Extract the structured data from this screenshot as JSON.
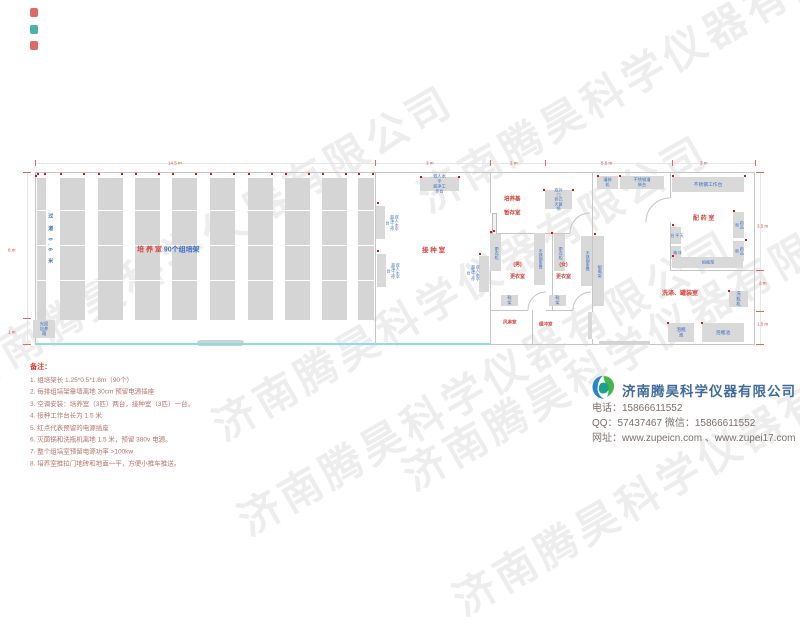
{
  "watermark": {
    "text": "济南腾昊科学仪器有限公司",
    "positions": [
      [
        -55,
        350
      ],
      [
        200,
        400
      ],
      [
        405,
        172
      ],
      [
        225,
        495
      ],
      [
        440,
        575
      ],
      [
        390,
        450
      ]
    ]
  },
  "corner_marks": [
    {
      "x": 30,
      "y": 8,
      "color": "#d4554b"
    },
    {
      "x": 30,
      "y": 25,
      "color": "#2ba49b"
    },
    {
      "x": 30,
      "y": 41,
      "color": "#d4554b"
    }
  ],
  "plan": {
    "colors": {
      "wall": "#c6c6c6",
      "box": "#d9d9d9",
      "bar": "#d5d5d5",
      "red_label": "#d9453c",
      "blue_label": "#3a6fc4",
      "outlet": "#e01010",
      "cyan": "#8fdbe6",
      "dim": "#d9453c"
    },
    "walls": [
      [
        35,
        172,
        720,
        1
      ],
      [
        35,
        344,
        720,
        1
      ],
      [
        35,
        172,
        1,
        173
      ],
      [
        754,
        172,
        1,
        173
      ],
      [
        375,
        172,
        1,
        172
      ],
      [
        490,
        172,
        1,
        41
      ],
      [
        490,
        239,
        1,
        106
      ],
      [
        592,
        172,
        1,
        140
      ],
      [
        592,
        339,
        1,
        6
      ],
      [
        490,
        233,
        80,
        1
      ],
      [
        552,
        233,
        1,
        77
      ],
      [
        490,
        310,
        38,
        1
      ],
      [
        546,
        310,
        27,
        1
      ],
      [
        532,
        310,
        1,
        34
      ],
      [
        670,
        172,
        1,
        26
      ],
      [
        670,
        222,
        1,
        48
      ],
      [
        670,
        270,
        85,
        1
      ]
    ],
    "dim_lines": [
      [
        35,
        163,
        720,
        1
      ],
      [
        27,
        172,
        1,
        173
      ],
      [
        760,
        172,
        1,
        173
      ]
    ],
    "ticks": {
      "top": [
        35,
        375,
        490,
        545,
        672,
        755
      ],
      "left": [
        172,
        318,
        344
      ],
      "right": [
        172,
        270,
        311,
        344
      ]
    },
    "dim_labels": [
      {
        "t": "14.5 m",
        "x": 168,
        "y": 156,
        "fs": 4.5
      },
      {
        "t": "3 m",
        "x": 426,
        "y": 156,
        "fs": 4.5
      },
      {
        "t": "2 m",
        "x": 510,
        "y": 156,
        "fs": 4.5
      },
      {
        "t": "5.5 m",
        "x": 601,
        "y": 156,
        "fs": 4.5
      },
      {
        "t": "3 m",
        "x": 700,
        "y": 156,
        "fs": 4.5
      },
      {
        "t": "3.5 m",
        "x": 757,
        "y": 219,
        "fs": 4.5
      },
      {
        "t": "2 m",
        "x": 759,
        "y": 276,
        "fs": 4.5
      },
      {
        "t": "1.5 m",
        "x": 757,
        "y": 317,
        "fs": 4.5
      },
      {
        "t": "8 m",
        "x": 8,
        "y": 243,
        "fs": 4.5
      },
      {
        "t": "1 m",
        "x": 8,
        "y": 325,
        "fs": 4.5
      }
    ],
    "shelf": {
      "bars": [
        [
          37,
          178,
          9,
          142
        ],
        [
          60,
          178,
          25,
          142
        ],
        [
          98,
          178,
          25,
          142
        ],
        [
          135,
          178,
          25,
          142
        ],
        [
          172,
          178,
          25,
          142
        ],
        [
          210,
          178,
          25,
          142
        ],
        [
          248,
          178,
          25,
          142
        ],
        [
          285,
          178,
          25,
          142
        ],
        [
          322,
          178,
          25,
          142
        ],
        [
          358,
          178,
          16,
          142
        ]
      ],
      "dividers": [
        210,
        245,
        280
      ]
    },
    "room_labels": [
      {
        "name": "culture-room-label",
        "x": 137,
        "y": 242,
        "fs": 7,
        "parts": [
          {
            "t": "培 养 室 ",
            "c": "#d9453c"
          },
          {
            "t": "90个组培架",
            "c": "#3a6fc4"
          }
        ]
      },
      {
        "name": "aisle-label",
        "x": 46,
        "y": 213,
        "fs": 5,
        "v": 1,
        "ls": 6,
        "parts": [
          {
            "t": "过 道 0.6 米",
            "c": "#3a6fc4"
          }
        ]
      },
      {
        "name": "inoculation-room-label",
        "x": 422,
        "y": 243,
        "fs": 6.5,
        "parts": [
          {
            "t": "接 种 室",
            "c": "#d9453c"
          }
        ]
      },
      {
        "name": "medium-storage-label",
        "x": 504,
        "y": 192,
        "fs": 5.5,
        "lh": 2.6,
        "parts": [
          {
            "t": "培养基\n暂存室",
            "c": "#d9453c"
          }
        ]
      },
      {
        "name": "male-changing-label",
        "x": 510,
        "y": 259,
        "fs": 5,
        "lh": 2.4,
        "parts": [
          {
            "t": "(男)\n更衣室",
            "c": "#d9453c"
          }
        ]
      },
      {
        "name": "female-changing-label",
        "x": 556,
        "y": 259,
        "fs": 5,
        "lh": 2.4,
        "parts": [
          {
            "t": "(女)\n更衣室",
            "c": "#d9453c"
          }
        ]
      },
      {
        "name": "air-shower-label",
        "x": 503,
        "y": 317,
        "fs": 4.5,
        "parts": [
          {
            "t": "风淋室",
            "c": "#d9453c"
          }
        ]
      },
      {
        "name": "buffer-room-label",
        "x": 539,
        "y": 319,
        "fs": 4.5,
        "parts": [
          {
            "t": "缓冲室",
            "c": "#d9453c"
          }
        ]
      },
      {
        "name": "prep-room-label",
        "x": 693,
        "y": 212,
        "fs": 6,
        "parts": [
          {
            "t": "配 药 室",
            "c": "#d9453c"
          }
        ]
      },
      {
        "name": "washing-room-label",
        "x": 662,
        "y": 287,
        "fs": 6,
        "parts": [
          {
            "t": "洗涤、罐装室",
            "c": "#d9453c"
          }
        ]
      }
    ],
    "equipment": [
      {
        "n": "light-incubator",
        "l": "光照\n培养箱",
        "x": 33,
        "y": 320,
        "w": 22,
        "h": 18,
        "fs": 4.3
      },
      {
        "n": "clean-bench-top",
        "l": "双人水平\n超净工作台",
        "x": 420,
        "y": 177,
        "w": 39,
        "h": 14,
        "fs": 4.2
      },
      {
        "n": "clean-bench-left-1",
        "x": 376,
        "y": 206,
        "w": 9,
        "h": 33
      },
      {
        "n": "clean-bench-left-1-label",
        "l": "双人水平\n超净工作台",
        "x": 385,
        "y": 203,
        "w": 13,
        "h": 40,
        "v": 1,
        "nb": 1,
        "fs": 4
      },
      {
        "n": "clean-bench-left-2",
        "x": 377,
        "y": 254,
        "w": 9,
        "h": 33
      },
      {
        "n": "clean-bench-left-2-label",
        "l": "双人水平\n超净工作台",
        "x": 386,
        "y": 251,
        "w": 13,
        "h": 40,
        "v": 1,
        "nb": 1,
        "fs": 4
      },
      {
        "n": "clean-bench-right",
        "x": 479,
        "y": 256,
        "w": 10,
        "h": 36
      },
      {
        "n": "clean-bench-right-label",
        "l": "双人水平\n超净工作台",
        "x": 466,
        "y": 253,
        "w": 13,
        "h": 40,
        "v": 1,
        "nb": 1,
        "fs": 4
      },
      {
        "n": "sterilizer",
        "l": "双外门\n卧式灭菌锅",
        "x": 545,
        "y": 190,
        "w": 27,
        "h": 19,
        "fs": 4
      },
      {
        "n": "locker-male",
        "l": "更衣柜",
        "x": 490,
        "y": 234,
        "w": 11,
        "h": 37,
        "v": 1,
        "fs": 4.2
      },
      {
        "n": "bench-male",
        "l": "不锈钢条凳",
        "x": 534,
        "y": 233,
        "w": 11,
        "h": 52,
        "v": 1,
        "fs": 4
      },
      {
        "n": "locker-female",
        "l": "更衣柜",
        "x": 554,
        "y": 234,
        "w": 11,
        "h": 37,
        "v": 1,
        "fs": 4.2
      },
      {
        "n": "bench-female",
        "l": "不锈钢条凳",
        "x": 581,
        "y": 236,
        "w": 11,
        "h": 50,
        "v": 1,
        "fs": 4
      },
      {
        "n": "bottle-rack-wall",
        "l": "组瓶架",
        "x": 593,
        "y": 236,
        "w": 11,
        "h": 70,
        "v": 1,
        "fs": 4.2
      },
      {
        "n": "shoe-rack-male",
        "l": "鞋架",
        "x": 501,
        "y": 295,
        "w": 17,
        "h": 11,
        "fs": 4.2
      },
      {
        "n": "shoe-rack-female",
        "l": "鞋架",
        "x": 549,
        "y": 295,
        "w": 17,
        "h": 11,
        "fs": 4.2
      },
      {
        "n": "filling-machine",
        "l": "灌装机",
        "x": 597,
        "y": 176,
        "w": 21,
        "h": 13,
        "fs": 4.2
      },
      {
        "n": "filling-table",
        "l": "不锈钢灌装台",
        "x": 620,
        "y": 176,
        "w": 44,
        "h": 13,
        "fs": 4.2
      },
      {
        "n": "bottle-washer",
        "l": "洗瓶机",
        "x": 729,
        "y": 291,
        "w": 19,
        "h": 16,
        "fs": 4.5
      },
      {
        "n": "soak-pool-1",
        "l": "泡瓶池",
        "x": 668,
        "y": 323,
        "w": 26,
        "h": 19,
        "fs": 4.8
      },
      {
        "n": "soak-pool-2",
        "l": "泡瓶池",
        "x": 702,
        "y": 323,
        "w": 42,
        "h": 19,
        "fs": 4.8
      },
      {
        "n": "stainless-worktable",
        "l": "不锈钢工作台",
        "x": 672,
        "y": 177,
        "w": 72,
        "h": 15,
        "fs": 4.8
      },
      {
        "n": "balance-table",
        "l": "天平台",
        "x": 671,
        "y": 227,
        "w": 10,
        "h": 17,
        "v": 1,
        "fs": 4
      },
      {
        "n": "fridge",
        "l": "冰箱",
        "x": 671,
        "y": 246,
        "w": 10,
        "h": 13,
        "v": 1,
        "fs": 4
      },
      {
        "n": "medicine-cabinet-1",
        "l": "药品柜",
        "x": 733,
        "y": 212,
        "w": 11,
        "h": 26,
        "v": 1,
        "fs": 4
      },
      {
        "n": "medicine-cabinet-2",
        "l": "药品柜",
        "x": 733,
        "y": 241,
        "w": 11,
        "h": 20,
        "v": 1,
        "fs": 4
      },
      {
        "n": "bottle-rack-prep",
        "l": "组瓶架",
        "x": 672,
        "y": 257,
        "w": 71,
        "h": 11,
        "fs": 4.2
      }
    ],
    "arcs": [
      "M528 310 A18 18 0 0 1 546 292",
      "M573 310 A18 18 0 0 1 591 292",
      "M570 233 A20 20 0 0 1 590 213",
      "M646 222 A24 24 0 0 1 670 198"
    ],
    "door_rects": [
      {
        "x": 492,
        "y": 213,
        "w": 3,
        "h": 26,
        "f": "#f2f2f2",
        "b": "#bdbdbd",
        "n": "door-leaf-inoculation"
      },
      {
        "x": 588,
        "y": 312,
        "w": 4,
        "h": 27,
        "f": "#d9d9d9",
        "n": "door-leaf-buffer"
      },
      {
        "x": 197,
        "y": 340,
        "w": 47,
        "h": 6,
        "f": "#c9d4d4",
        "r": 3,
        "n": "sliding-door-culture"
      },
      {
        "x": 599,
        "y": 341,
        "w": 51,
        "h": 4,
        "f": "#d4d4d4",
        "n": "door-washing-room"
      }
    ],
    "cyan_line": [
      35,
      343,
      455,
      2
    ],
    "outlets": [
      [
        37,
        173
      ],
      [
        44,
        173
      ],
      [
        60,
        173
      ],
      [
        83,
        173
      ],
      [
        98,
        173
      ],
      [
        121,
        173
      ],
      [
        135,
        173
      ],
      [
        158,
        173
      ],
      [
        172,
        173
      ],
      [
        195,
        173
      ],
      [
        210,
        173
      ],
      [
        233,
        173
      ],
      [
        248,
        173
      ],
      [
        271,
        173
      ],
      [
        285,
        173
      ],
      [
        308,
        173
      ],
      [
        322,
        173
      ],
      [
        345,
        173
      ],
      [
        358,
        173
      ],
      [
        372,
        173
      ],
      [
        377,
        202
      ],
      [
        377,
        250
      ],
      [
        420,
        176
      ],
      [
        458,
        176
      ],
      [
        479,
        253
      ],
      [
        493,
        230
      ],
      [
        543,
        189
      ],
      [
        572,
        189
      ],
      [
        672,
        224
      ],
      [
        672,
        255
      ],
      [
        733,
        210
      ],
      [
        745,
        239
      ],
      [
        672,
        175
      ],
      [
        744,
        175
      ],
      [
        619,
        175
      ],
      [
        597,
        175
      ],
      [
        728,
        290
      ],
      [
        667,
        322
      ],
      [
        701,
        322
      ],
      [
        594,
        233
      ],
      [
        490,
        231
      ],
      [
        551,
        232
      ],
      [
        35,
        175
      ]
    ]
  },
  "notes": {
    "title": "备注：",
    "items": [
      "1. 组培架长 1.25*0.5*1.8m（90个）",
      "2. 每排组培架靠墙离地 30cm 预留电源插座",
      "3. 空调安装：培养室（3匹）两台，接种室（3匹）一台。",
      "4. 接种工作台长为 1.5 米",
      "5. 红点代表预留的电源插座",
      "6. 灭菌锅和洗瓶机离地 1.5 米，预留 380v 电源。",
      "7. 整个组培室预留电源功率 >100kw",
      "8. 培养室推拉门地砖和地面一平，方便小推车推送。"
    ]
  },
  "company": {
    "name": "济南腾昊科学仪器有限公司",
    "phone_line": "电话：15866611552",
    "qq_line": "QQ：57437467   微信：15866611552",
    "web_line": "网址：www.zupeicn.com 、www.zupei17.com"
  }
}
